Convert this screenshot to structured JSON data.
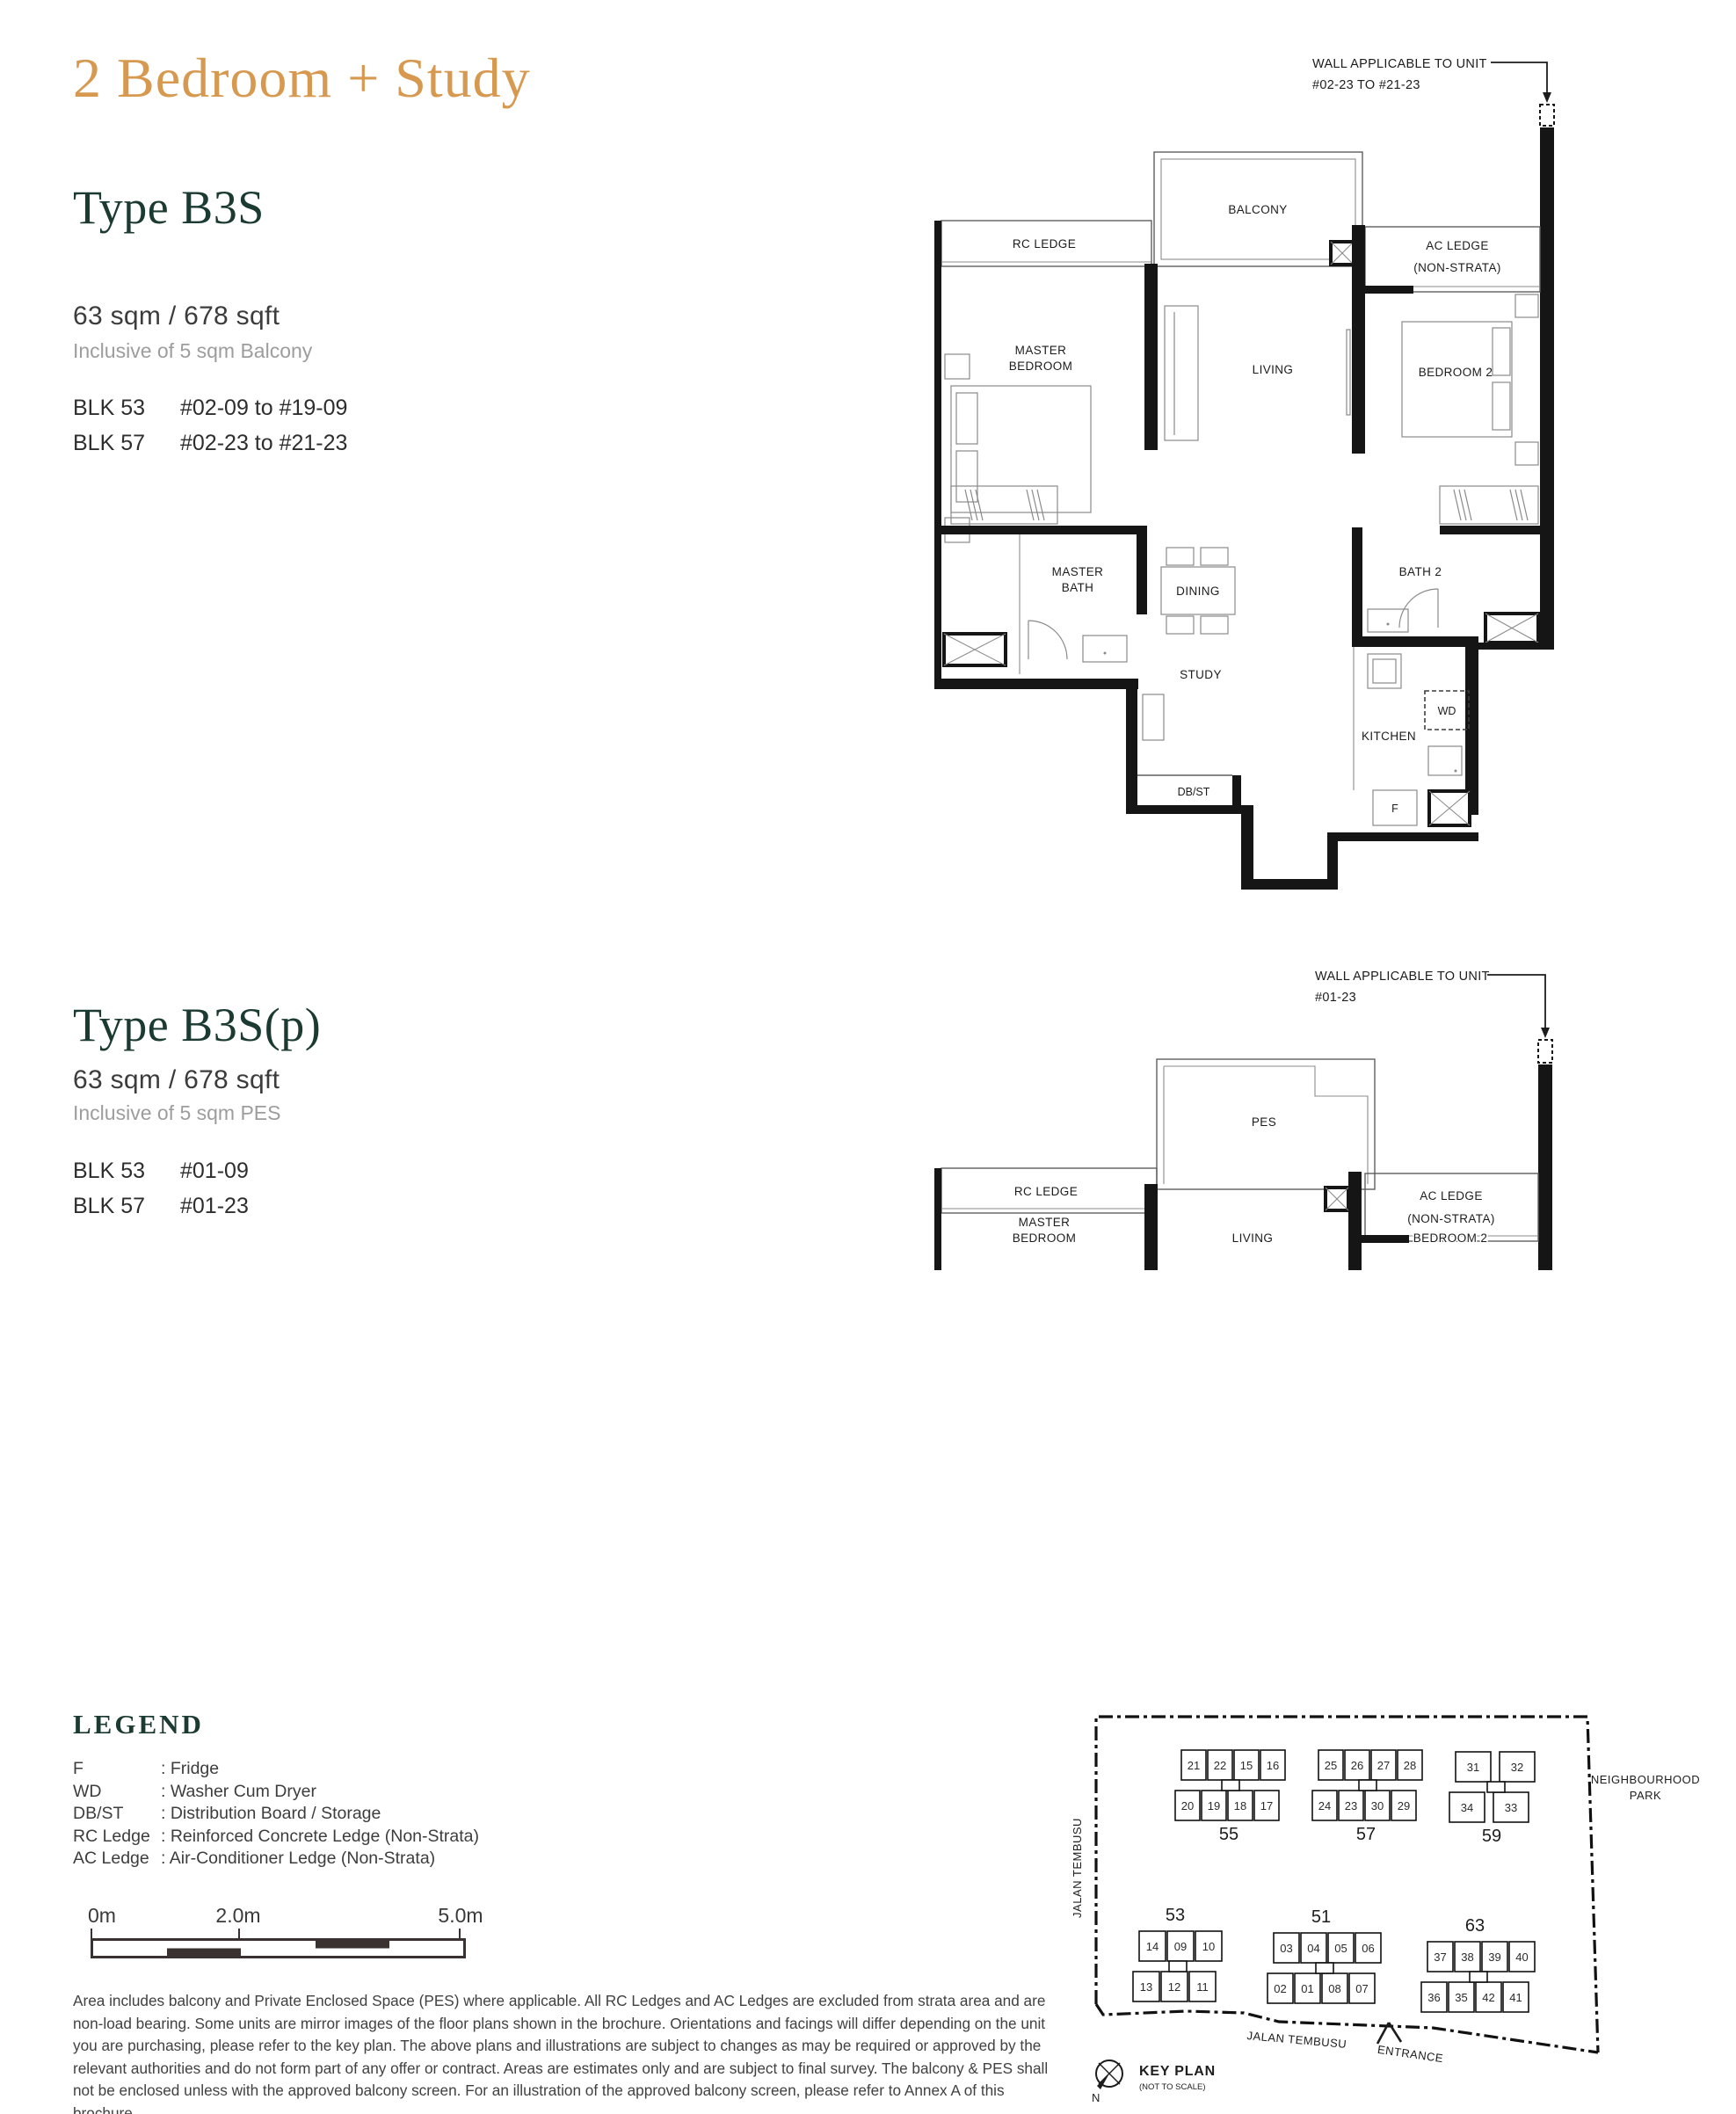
{
  "page_title": "2 Bedroom + Study",
  "colors": {
    "accent": "#d6994f",
    "heading": "#1b3a31",
    "highlight": "#efa56b"
  },
  "sections": [
    {
      "type_name": "Type B3S",
      "area": "63 sqm / 678 sqft",
      "inclusive": "Inclusive of 5 sqm Balcony",
      "units": [
        {
          "blk": "BLK 53",
          "range": "#02-09 to #19-09"
        },
        {
          "blk": "BLK 57",
          "range": "#02-23 to #21-23"
        }
      ]
    },
    {
      "type_name": "Type B3S(p)",
      "area": "63 sqm / 678 sqft",
      "inclusive": "Inclusive of 5 sqm PES",
      "units": [
        {
          "blk": "BLK 53",
          "range": "#01-09"
        },
        {
          "blk": "BLK 57",
          "range": "#01-23"
        }
      ]
    }
  ],
  "plan1": {
    "annotation_1": "WALL APPLICABLE TO UNIT",
    "annotation_2": "#02-23 TO #21-23",
    "labels": {
      "balcony": "BALCONY",
      "rc_ledge": "RC LEDGE",
      "ac_ledge_1": "AC LEDGE",
      "ac_ledge_2": "(NON-STRATA)",
      "master_1": "MASTER",
      "master_2": "BEDROOM",
      "living": "LIVING",
      "bedroom2": "BEDROOM 2",
      "mbath_1": "MASTER",
      "mbath_2": "BATH",
      "dining": "DINING",
      "bath2": "BATH 2",
      "study": "STUDY",
      "kitchen": "KITCHEN",
      "wd": "WD",
      "fridge": "F",
      "dbst": "DB/ST"
    }
  },
  "plan2": {
    "annotation_1": "WALL APPLICABLE TO UNIT",
    "annotation_2": "#01-23",
    "labels": {
      "pes": "PES",
      "rc_ledge": "RC LEDGE",
      "ac_ledge_1": "AC LEDGE",
      "ac_ledge_2": "(NON-STRATA)",
      "master_1": "MASTER",
      "master_2": "BEDROOM",
      "living": "LIVING",
      "bedroom2": "BEDROOM 2"
    }
  },
  "legend": {
    "title": "LEGEND",
    "items": [
      {
        "term": "F",
        "definition": "Fridge"
      },
      {
        "term": "WD",
        "definition": "Washer Cum Dryer"
      },
      {
        "term": "DB/ST",
        "definition": "Distribution Board / Storage"
      },
      {
        "term": "RC Ledge",
        "definition": "Reinforced Concrete Ledge (Non-Strata)"
      },
      {
        "term": "AC Ledge",
        "definition": "Air-Conditioner Ledge (Non-Strata)"
      }
    ]
  },
  "scale_bar": {
    "labels": [
      "0m",
      "2.0m",
      "5.0m"
    ]
  },
  "disclaimer": "Area includes balcony and Private Enclosed Space (PES) where applicable. All RC Ledges and AC Ledges are excluded from strata area and are non-load bearing. Some units are mirror images of the floor plans shown in the brochure. Orientations and facings will differ depending on the unit you are purchasing, please refer to the key plan. The above plans and illustrations are subject to changes as may be required or approved by the relevant authorities and do not form part of any offer or contract. Areas are estimates only and are subject to final survey. The balcony & PES shall not be enclosed unless with the approved balcony screen. For an illustration of the approved balcony screen, please refer to Annex A of this brochure.",
  "key_plan": {
    "title": "KEY PLAN",
    "subtitle": "(NOT TO SCALE)",
    "north_label": "N",
    "park_label_1": "NEIGHBOURHOOD",
    "park_label_2": "PARK",
    "road_left": "JALAN TEMBUSU",
    "road_bottom": "JALAN TEMBUSU",
    "entrance_label": "ENTRANCE",
    "blocks": [
      {
        "id": "55",
        "row1": [
          "21",
          "22",
          "15",
          "16"
        ],
        "row2": [
          "20",
          "19",
          "18",
          "17"
        ],
        "highlight": ""
      },
      {
        "id": "57",
        "row1": [
          "25",
          "26",
          "27",
          "28"
        ],
        "row2": [
          "24",
          "23",
          "30",
          "29"
        ],
        "highlight": "23"
      },
      {
        "id": "59",
        "row1": [
          "31",
          "32"
        ],
        "row2": [
          "34",
          "33"
        ],
        "highlight": ""
      },
      {
        "id": "53",
        "row1": [
          "14",
          "09",
          "10"
        ],
        "row2": [
          "13",
          "12",
          "11"
        ],
        "highlight": "09"
      },
      {
        "id": "51",
        "row1": [
          "03",
          "04",
          "05",
          "06"
        ],
        "row2": [
          "02",
          "01",
          "08",
          "07"
        ],
        "highlight": ""
      },
      {
        "id": "63",
        "row1": [
          "37",
          "38",
          "39",
          "40"
        ],
        "row2": [
          "36",
          "35",
          "42",
          "41"
        ],
        "highlight": ""
      }
    ]
  }
}
